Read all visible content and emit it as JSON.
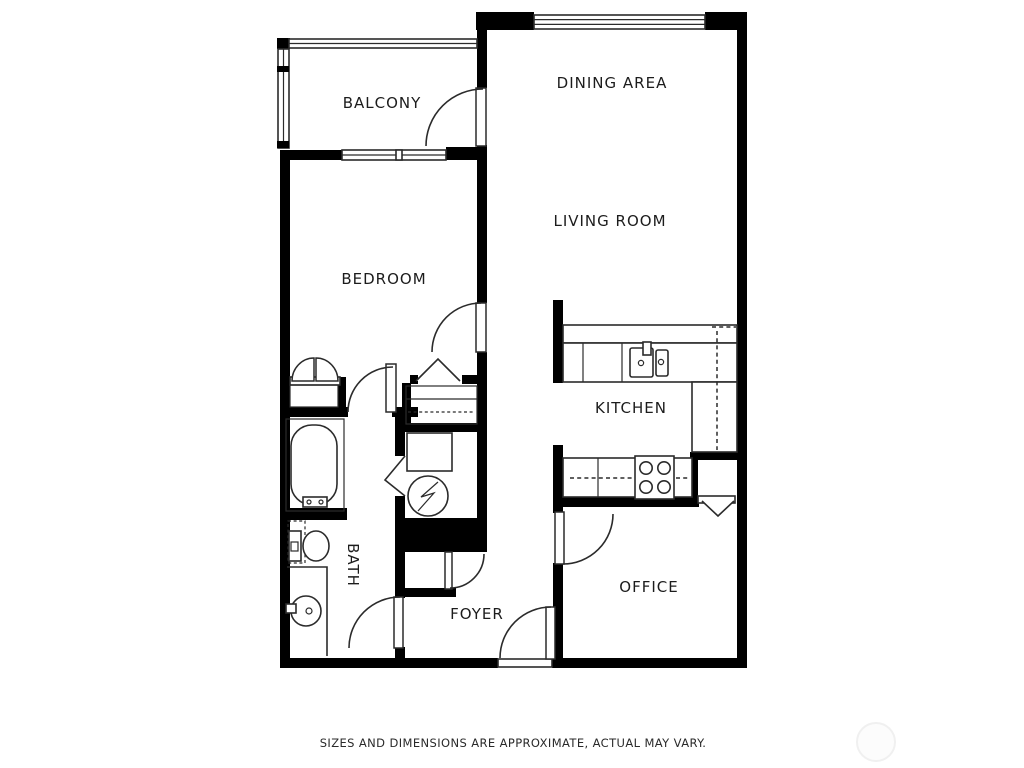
{
  "plan": {
    "title": "apartment-floor-plan",
    "rooms": [
      {
        "id": "balcony",
        "label": "BALCONY"
      },
      {
        "id": "dining",
        "label": "DINING AREA"
      },
      {
        "id": "living",
        "label": "LIVING ROOM"
      },
      {
        "id": "bedroom",
        "label": "BEDROOM"
      },
      {
        "id": "kitchen",
        "label": "KITCHEN"
      },
      {
        "id": "office",
        "label": "OFFICE"
      },
      {
        "id": "bath",
        "label": "BATH"
      },
      {
        "id": "foyer",
        "label": "FOYER"
      }
    ],
    "disclaimer": "SIZES AND DIMENSIONS ARE APPROXIMATE, ACTUAL MAY VARY.",
    "colors": {
      "wall": "#000000",
      "line": "#2b2b2b",
      "background": "#ffffff"
    }
  }
}
